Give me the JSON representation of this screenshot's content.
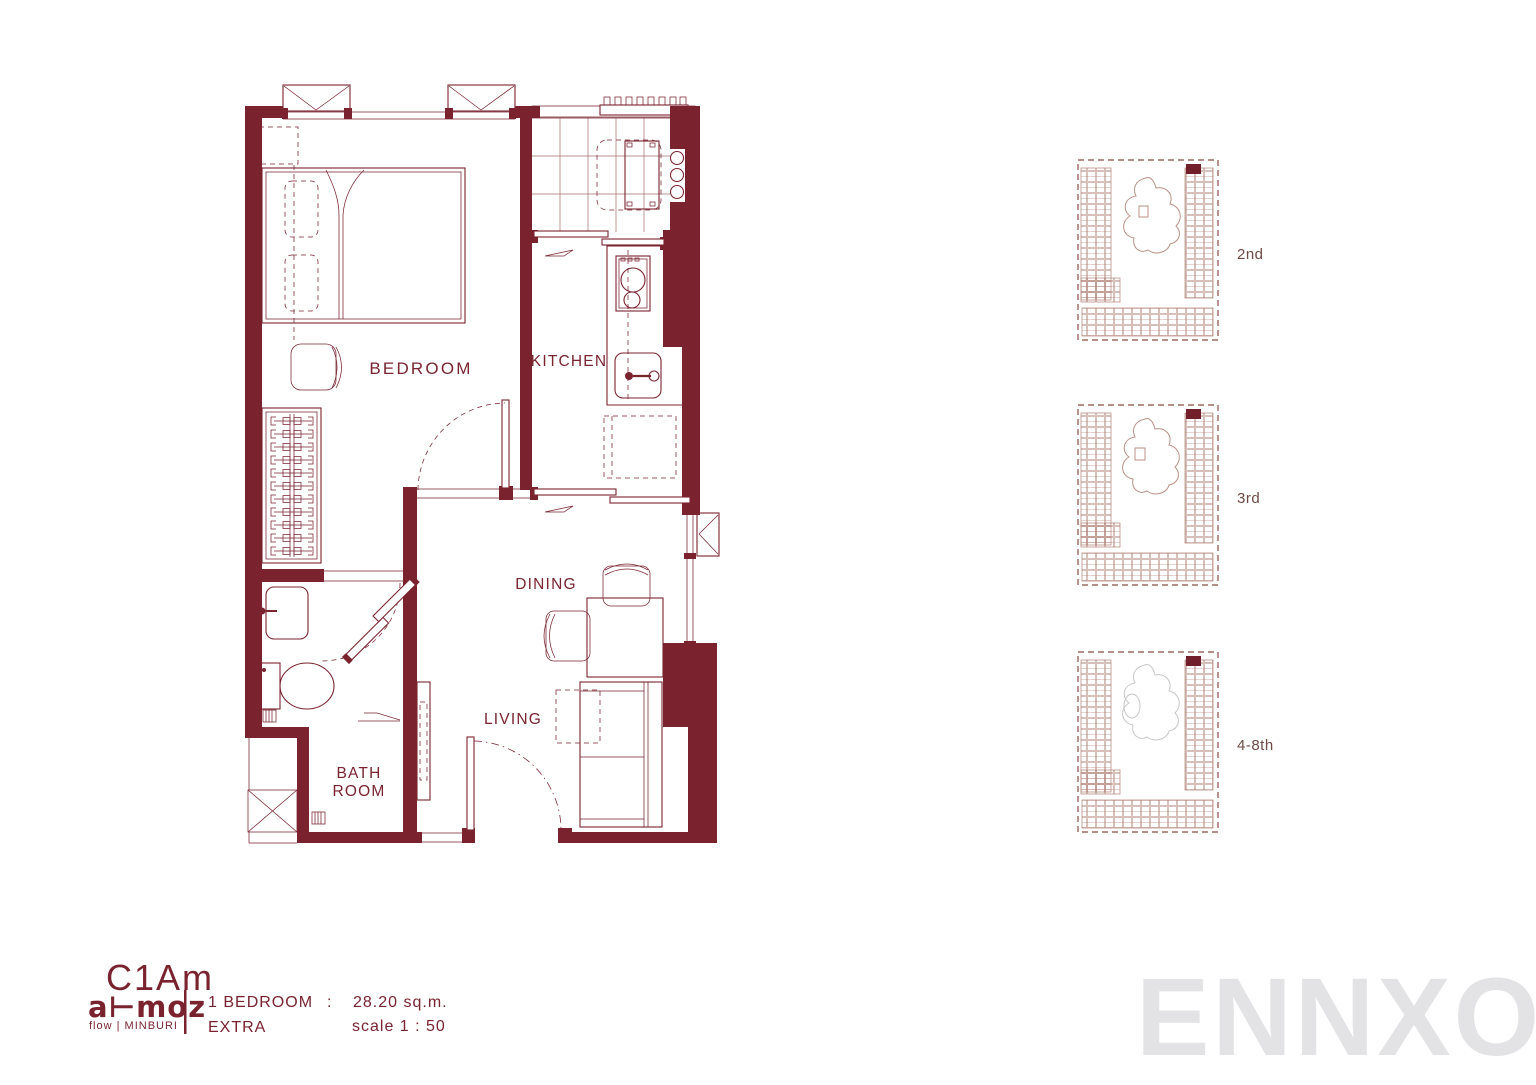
{
  "colors": {
    "wall": "#7a232f",
    "line": "#7a232f",
    "text": "#7a232f",
    "grid": "#a4706c",
    "keyplan": "#b08176",
    "keyplan_border": "#8a4a45",
    "keyplan_marker": "#701f2b",
    "keyplan_blob": "#bb9186",
    "keyplan_blob_gray": "#c7c7c7",
    "keyplan_label": "#6f4a44",
    "watermark": "#e3e3e5"
  },
  "floorplan": {
    "rooms": {
      "bedroom": "BEDROOM",
      "kitchen": "KITCHEN",
      "dining": "DINING",
      "living": "LIVING",
      "bathroom_line1": "BATH",
      "bathroom_line2": "ROOM"
    }
  },
  "key_plans": [
    {
      "label": "2nd"
    },
    {
      "label": "3rd"
    },
    {
      "label": "4-8th"
    }
  ],
  "title_block": {
    "unit_code": "C1Am",
    "brand": "a⊢moz",
    "brand_sub": "flow | MINBURI",
    "spec_type": "1 BEDROOM",
    "spec_separator": ":",
    "spec_area": "28.20 sq.m.",
    "spec_extra": "EXTRA",
    "spec_scale": "scale 1 : 50"
  },
  "watermark": "ENNXO"
}
